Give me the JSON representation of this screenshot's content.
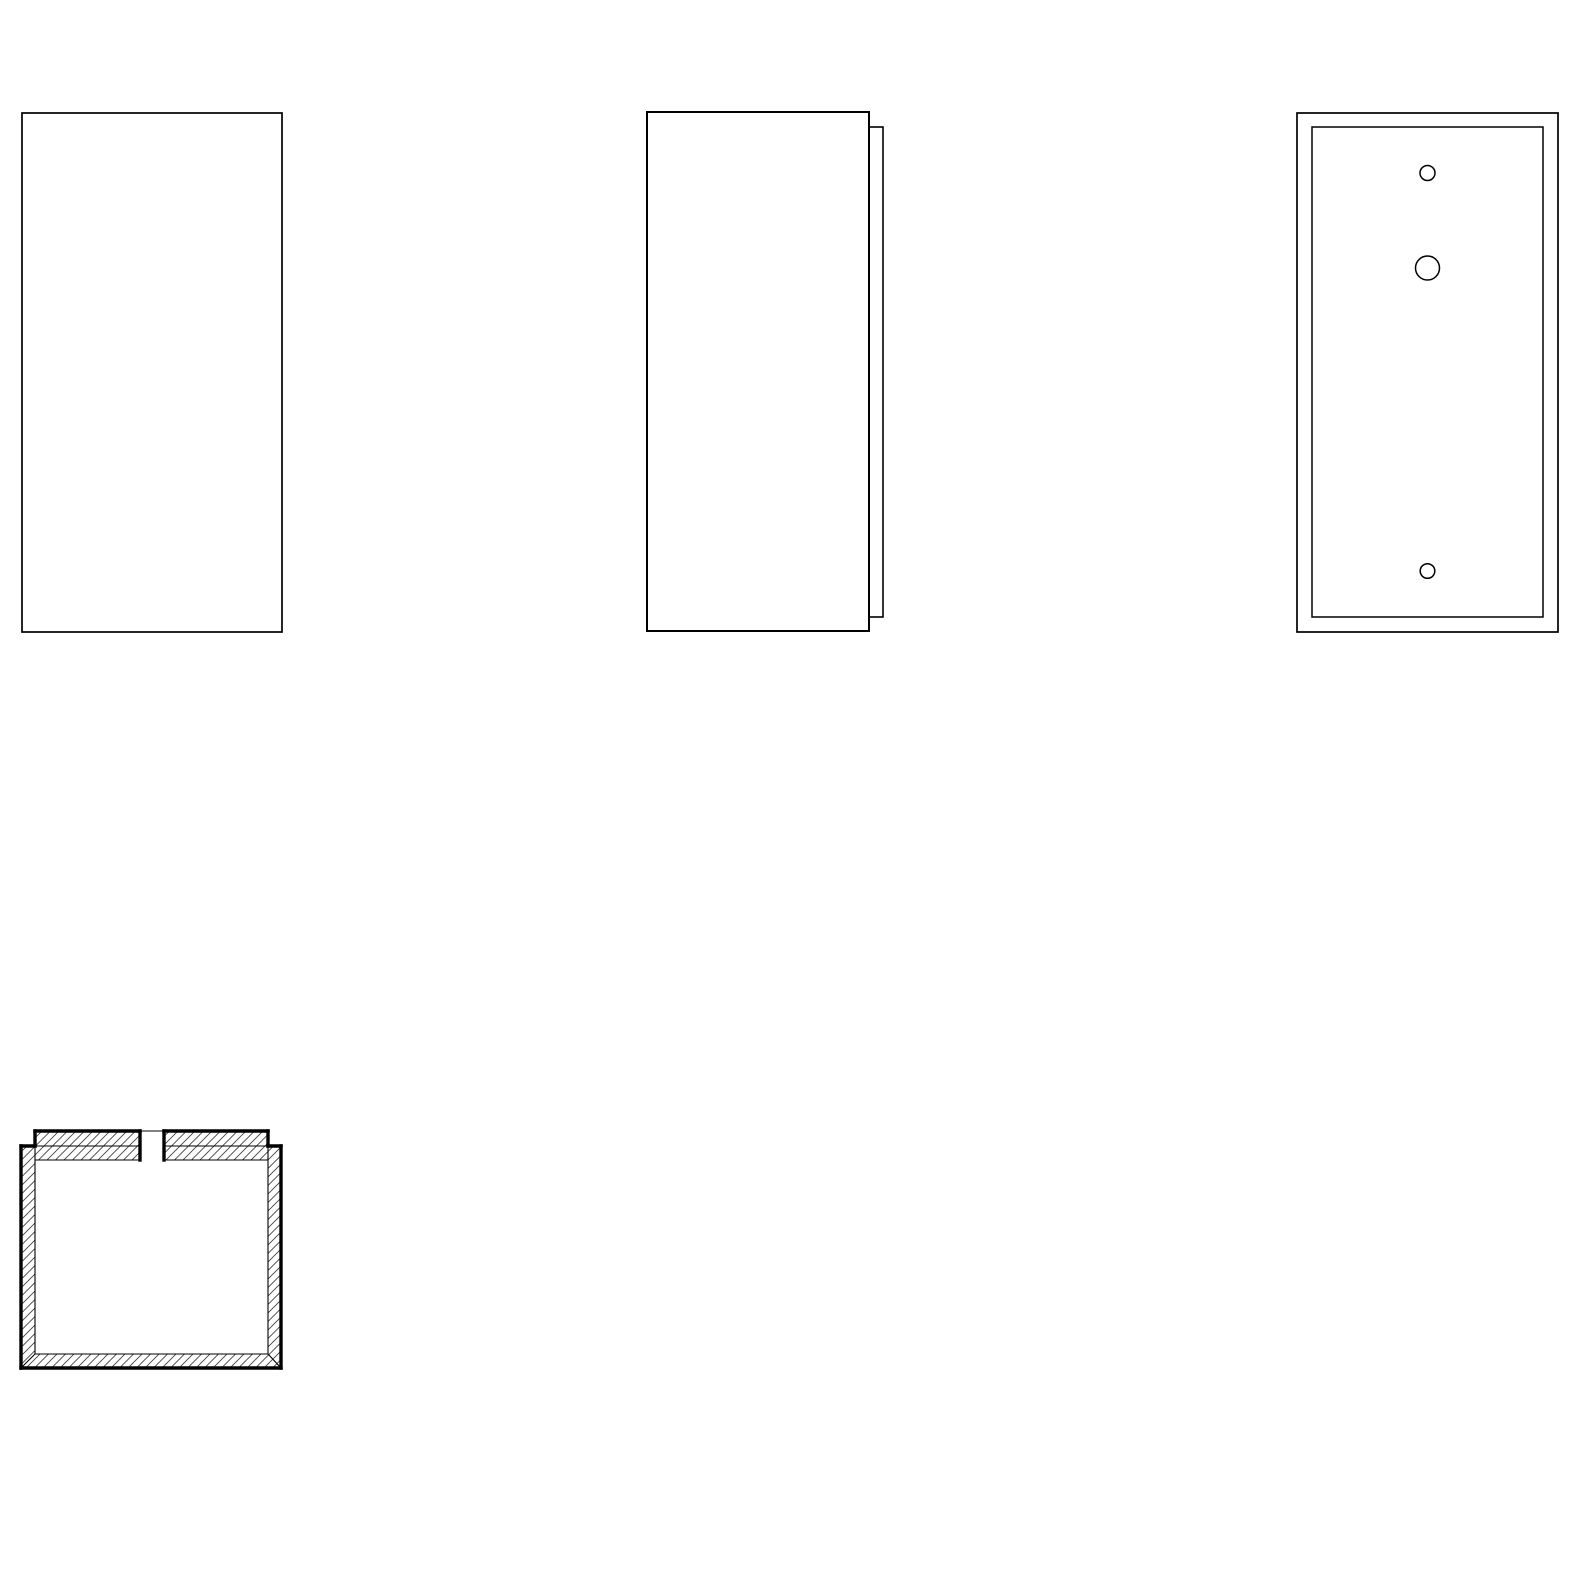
{
  "canvas": {
    "width": 1578,
    "height": 1578
  },
  "drawing": {
    "background": "#ffffff",
    "line_color": "#000000",
    "hatch": {
      "spacing": 8.5,
      "line_width": 0.9,
      "color": "#444444"
    },
    "views": [
      {
        "name": "front-view",
        "shapes": [
          {
            "name": "front-panel-outline",
            "type": "rect",
            "x": 22,
            "y": 113,
            "w": 260,
            "h": 519,
            "sw": 1.7,
            "fill": "#ffffff"
          }
        ]
      },
      {
        "name": "side-view",
        "shapes": [
          {
            "name": "back-plate-edge",
            "type": "rect",
            "x": 869,
            "y": 127,
            "w": 14,
            "h": 490,
            "sw": 1.6,
            "fill": "#ffffff"
          },
          {
            "name": "side-panel-outline",
            "type": "rect",
            "x": 647,
            "y": 112,
            "w": 222,
            "h": 519,
            "sw": 2,
            "fill": "#ffffff"
          }
        ]
      },
      {
        "name": "back-view",
        "shapes": [
          {
            "name": "back-panel-outline",
            "type": "rect",
            "x": 1297,
            "y": 113,
            "w": 261,
            "h": 519,
            "sw": 1.7,
            "fill": "#ffffff"
          },
          {
            "name": "back-plate-inner-edge",
            "type": "rect",
            "x": 1312,
            "y": 127,
            "w": 231,
            "h": 490,
            "sw": 1.5,
            "fill": "#ffffff"
          },
          {
            "name": "screw-hole-top",
            "type": "circle",
            "cx": 1427.5,
            "cy": 173,
            "r": 7.5,
            "sw": 1.5,
            "fill": "#ffffff"
          },
          {
            "name": "cable-hole",
            "type": "circle",
            "cx": 1427.5,
            "cy": 268,
            "r": 12,
            "sw": 1.5,
            "fill": "#ffffff"
          },
          {
            "name": "screw-hole-bottom",
            "type": "circle",
            "cx": 1427.5,
            "cy": 571,
            "r": 7.3,
            "sw": 1.5,
            "fill": "#ffffff"
          }
        ]
      },
      {
        "name": "section-view",
        "shapes": [
          {
            "name": "housing-walls-hatch",
            "type": "polygon",
            "fill": "hatch",
            "points": [
              [
                21,
                1146
              ],
              [
                21,
                1368
              ],
              [
                281,
                1368
              ],
              [
                281,
                1146
              ],
              [
                268,
                1146
              ],
              [
                268,
                1354
              ],
              [
                35,
                1354
              ],
              [
                35,
                1146
              ]
            ]
          },
          {
            "name": "back-plate-hatch-left",
            "type": "rect",
            "x": 35,
            "y": 1131,
            "w": 105,
            "h": 29,
            "fill": "hatch"
          },
          {
            "name": "back-plate-hatch-right",
            "type": "rect",
            "x": 164,
            "y": 1131,
            "w": 104,
            "h": 29,
            "fill": "hatch"
          },
          {
            "name": "inner-left-wall-face",
            "type": "line",
            "x1": 35,
            "y1": 1146,
            "x2": 35,
            "y2": 1354,
            "sw": 1.1
          },
          {
            "name": "inner-right-wall-face",
            "type": "line",
            "x1": 268,
            "y1": 1146,
            "x2": 268,
            "y2": 1354,
            "sw": 1.1
          },
          {
            "name": "inner-bottom-face",
            "type": "line",
            "x1": 35,
            "y1": 1354,
            "x2": 268,
            "y2": 1354,
            "sw": 1.1
          },
          {
            "name": "corner-miter-left",
            "type": "line",
            "x1": 35,
            "y1": 1354,
            "x2": 21,
            "y2": 1368,
            "sw": 1.1
          },
          {
            "name": "corner-miter-right",
            "type": "line",
            "x1": 268,
            "y1": 1354,
            "x2": 281,
            "y2": 1368,
            "sw": 1.1
          },
          {
            "name": "plate-bottom-left",
            "type": "line",
            "x1": 35,
            "y1": 1160,
            "x2": 140,
            "y2": 1160,
            "sw": 1.1
          },
          {
            "name": "plate-bottom-right",
            "type": "line",
            "x1": 164,
            "y1": 1160,
            "x2": 268,
            "y2": 1160,
            "sw": 1.1
          },
          {
            "name": "plate-seam-left",
            "type": "line",
            "x1": 35,
            "y1": 1146,
            "x2": 140,
            "y2": 1146,
            "sw": 1.1
          },
          {
            "name": "plate-seam-right",
            "type": "line",
            "x1": 164,
            "y1": 1146,
            "x2": 268,
            "y2": 1146,
            "sw": 1.1
          },
          {
            "name": "cable-notch-top-edge",
            "type": "line",
            "x1": 140,
            "y1": 1131,
            "x2": 164,
            "y2": 1131,
            "sw": 1.1
          },
          {
            "name": "plate-top-left",
            "type": "line",
            "x1": 35,
            "y1": 1131,
            "x2": 140,
            "y2": 1131,
            "sw": 3.4
          },
          {
            "name": "plate-top-right",
            "type": "line",
            "x1": 164,
            "y1": 1131,
            "x2": 268,
            "y2": 1131,
            "sw": 3.4
          },
          {
            "name": "cable-notch-left-edge",
            "type": "line",
            "x1": 140,
            "y1": 1131,
            "x2": 140,
            "y2": 1160,
            "sw": 3.4
          },
          {
            "name": "cable-notch-right-edge",
            "type": "line",
            "x1": 164,
            "y1": 1131,
            "x2": 164,
            "y2": 1160,
            "sw": 3.4
          },
          {
            "name": "plate-end-left",
            "type": "line",
            "x1": 35,
            "y1": 1131,
            "x2": 35,
            "y2": 1146,
            "sw": 3.4
          },
          {
            "name": "plate-end-right",
            "type": "line",
            "x1": 268,
            "y1": 1131,
            "x2": 268,
            "y2": 1146,
            "sw": 3.4
          },
          {
            "name": "rim-top-left",
            "type": "line",
            "x1": 21,
            "y1": 1146,
            "x2": 35,
            "y2": 1146,
            "sw": 3.4
          },
          {
            "name": "rim-top-right",
            "type": "line",
            "x1": 268,
            "y1": 1146,
            "x2": 281,
            "y2": 1146,
            "sw": 3.4
          },
          {
            "name": "outer-left-wall",
            "type": "line",
            "x1": 21,
            "y1": 1146,
            "x2": 21,
            "y2": 1368,
            "sw": 3.4
          },
          {
            "name": "outer-bottom-wall",
            "type": "line",
            "x1": 21,
            "y1": 1368,
            "x2": 281,
            "y2": 1368,
            "sw": 3.4
          },
          {
            "name": "outer-right-wall",
            "type": "line",
            "x1": 281,
            "y1": 1146,
            "x2": 281,
            "y2": 1368,
            "sw": 3.4
          }
        ]
      }
    ]
  }
}
